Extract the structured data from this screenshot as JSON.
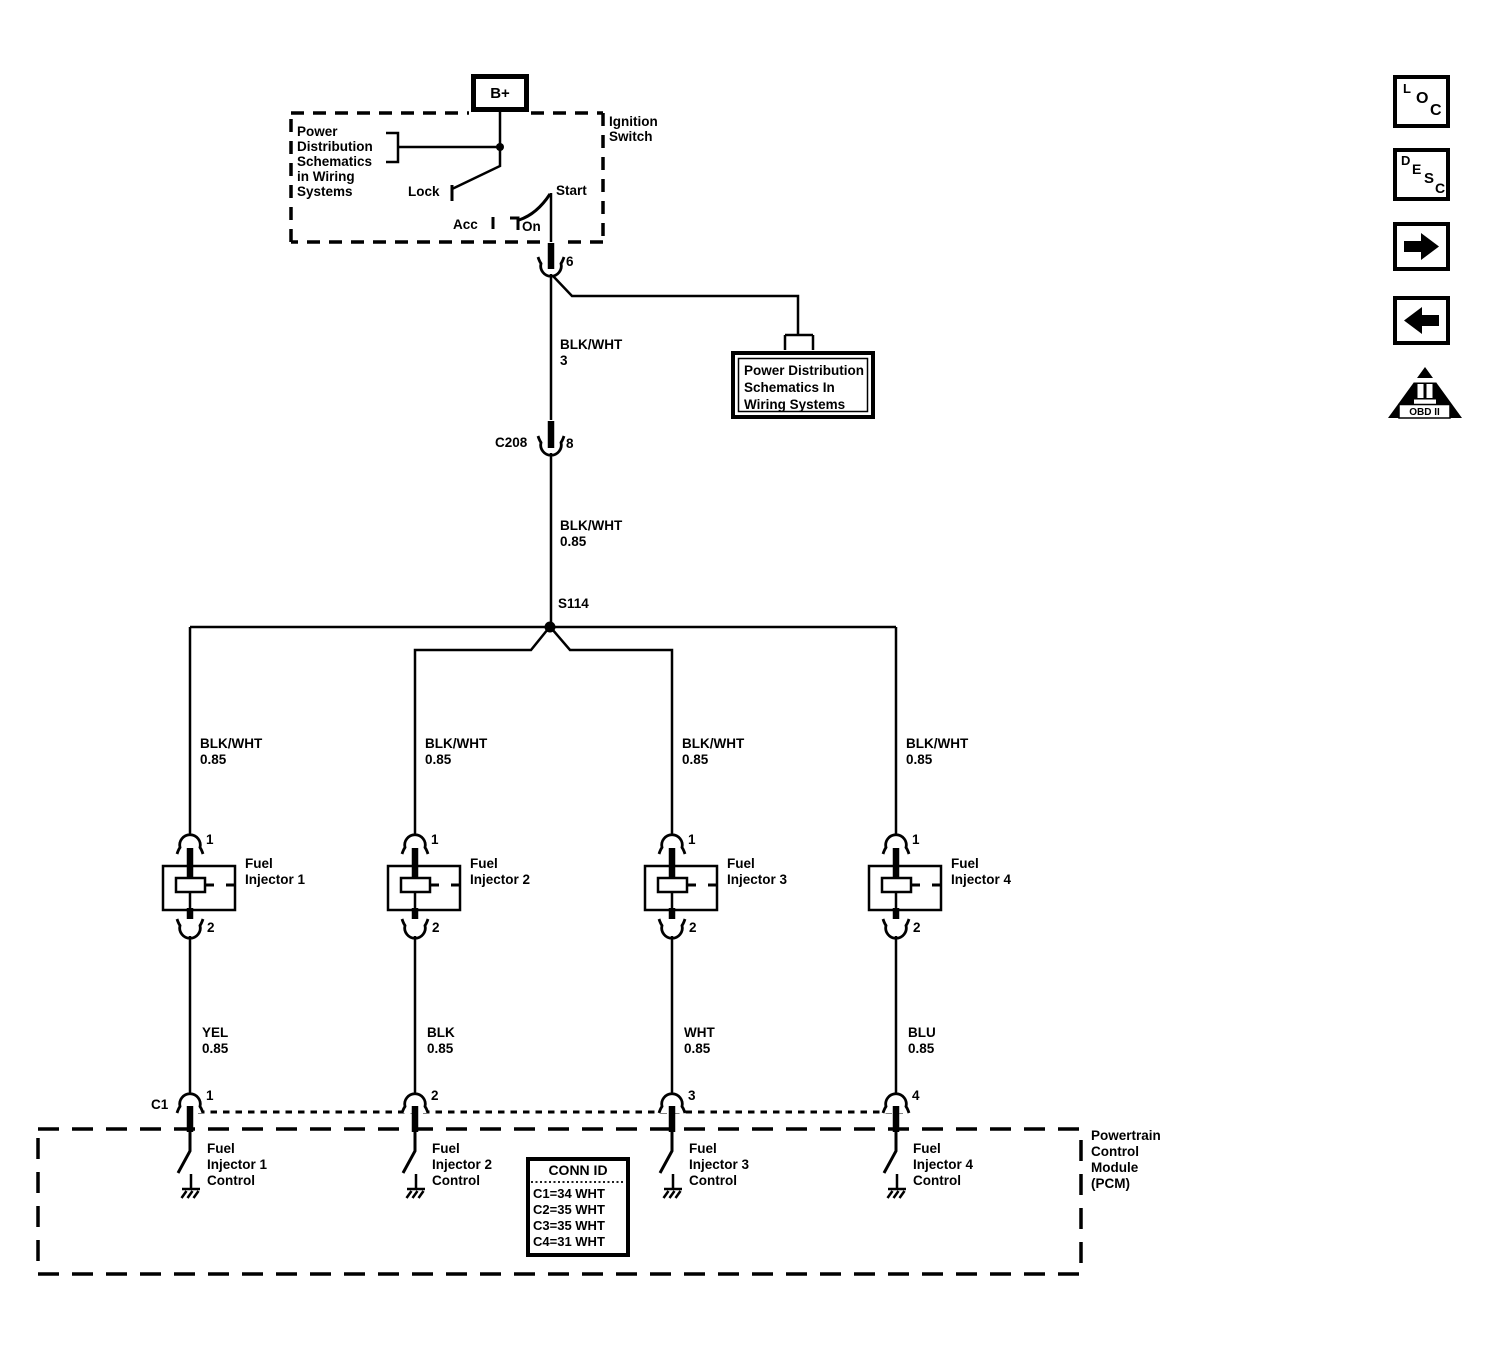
{
  "ignition": {
    "b_plus": "B+",
    "title_line1": "Ignition",
    "title_line2": "Switch",
    "note_line1": "Power",
    "note_line2": "Distribution",
    "note_line3": "Schematics",
    "note_line4": "in Wiring",
    "note_line5": "Systems",
    "pos_lock": "Lock",
    "pos_acc": "Acc",
    "pos_on": "On",
    "pos_start": "Start",
    "pin": "6"
  },
  "feed": {
    "wire1_color": "BLK/WHT",
    "wire1_size": "3",
    "branch_box_line1": "Power Distribution",
    "branch_box_line2": "Schematics In",
    "branch_box_line3": "Wiring Systems",
    "c208": "C208",
    "c208_pin": "8",
    "wire2_color": "BLK/WHT",
    "wire2_size": "0.85",
    "splice": "S114"
  },
  "branches": [
    {
      "feed_color": "BLK/WHT",
      "feed_size": "0.85",
      "pin_top": "1",
      "pin_bottom": "2",
      "device_line1": "Fuel",
      "device_line2": "Injector 1",
      "wire_color": "YEL",
      "wire_size": "0.85",
      "pcm_pin": "1",
      "control_line1": "Fuel",
      "control_line2": "Injector 1",
      "control_line3": "Control"
    },
    {
      "feed_color": "BLK/WHT",
      "feed_size": "0.85",
      "pin_top": "1",
      "pin_bottom": "2",
      "device_line1": "Fuel",
      "device_line2": "Injector 2",
      "wire_color": "BLK",
      "wire_size": "0.85",
      "pcm_pin": "2",
      "control_line1": "Fuel",
      "control_line2": "Injector 2",
      "control_line3": "Control"
    },
    {
      "feed_color": "BLK/WHT",
      "feed_size": "0.85",
      "pin_top": "1",
      "pin_bottom": "2",
      "device_line1": "Fuel",
      "device_line2": "Injector 3",
      "wire_color": "WHT",
      "wire_size": "0.85",
      "pcm_pin": "3",
      "control_line1": "Fuel",
      "control_line2": "Injector 3",
      "control_line3": "Control"
    },
    {
      "feed_color": "BLK/WHT",
      "feed_size": "0.85",
      "pin_top": "1",
      "pin_bottom": "2",
      "device_line1": "Fuel",
      "device_line2": "Injector 4",
      "wire_color": "BLU",
      "wire_size": "0.85",
      "pcm_pin": "4",
      "control_line1": "Fuel",
      "control_line2": "Injector 4",
      "control_line3": "Control"
    }
  ],
  "pcm": {
    "connector": "C1",
    "title_line1": "Powertrain",
    "title_line2": "Control",
    "title_line3": "Module",
    "title_line4": "(PCM)",
    "conn_header": "CONN ID",
    "conn_row1": "C1=34 WHT",
    "conn_row2": "C2=35 WHT",
    "conn_row3": "C3=35 WHT",
    "conn_row4": "C4=31 WHT"
  },
  "toolbar": {
    "loc_l1": "L",
    "loc_l2": "O",
    "loc_l3": "C",
    "desc_l1": "D",
    "desc_l2": "E",
    "desc_l3": "S",
    "desc_l4": "C",
    "obd_label": "OBD II"
  },
  "colors": {
    "line": "#000000",
    "background": "#ffffff"
  }
}
